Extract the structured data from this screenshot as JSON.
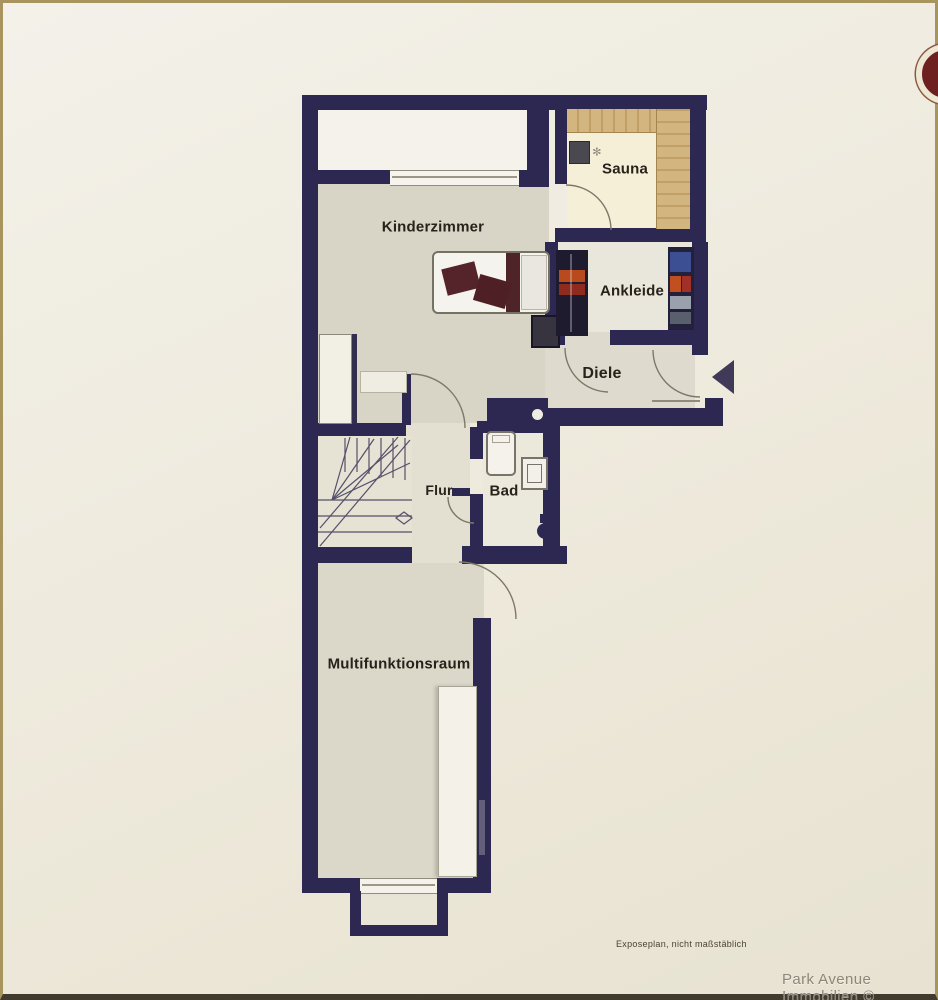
{
  "image_type": "real-estate floor plan photo (attic level)",
  "rooms": {
    "kinderzimmer": "Kinderzimmer",
    "sauna": "Sauna",
    "ankleide": "Ankleide",
    "diele": "Diele",
    "flur": "Flur",
    "bad": "Bad",
    "multifunktionsraum": "Multifunktionsraum"
  },
  "footer": {
    "disclaimer": "Exposeplan, nicht maßstäblich",
    "brand": "Park Avenue Immobilien ©"
  },
  "colors": {
    "wall_navy": "#2d2851",
    "paper_cream": "#eeeadc",
    "floor_grey": "#d8d5c6",
    "sauna_wood": "#c9ab76",
    "pillow_maroon": "#55232a",
    "logo_red": "#6e2020",
    "frame_tan": "#a8955e"
  }
}
